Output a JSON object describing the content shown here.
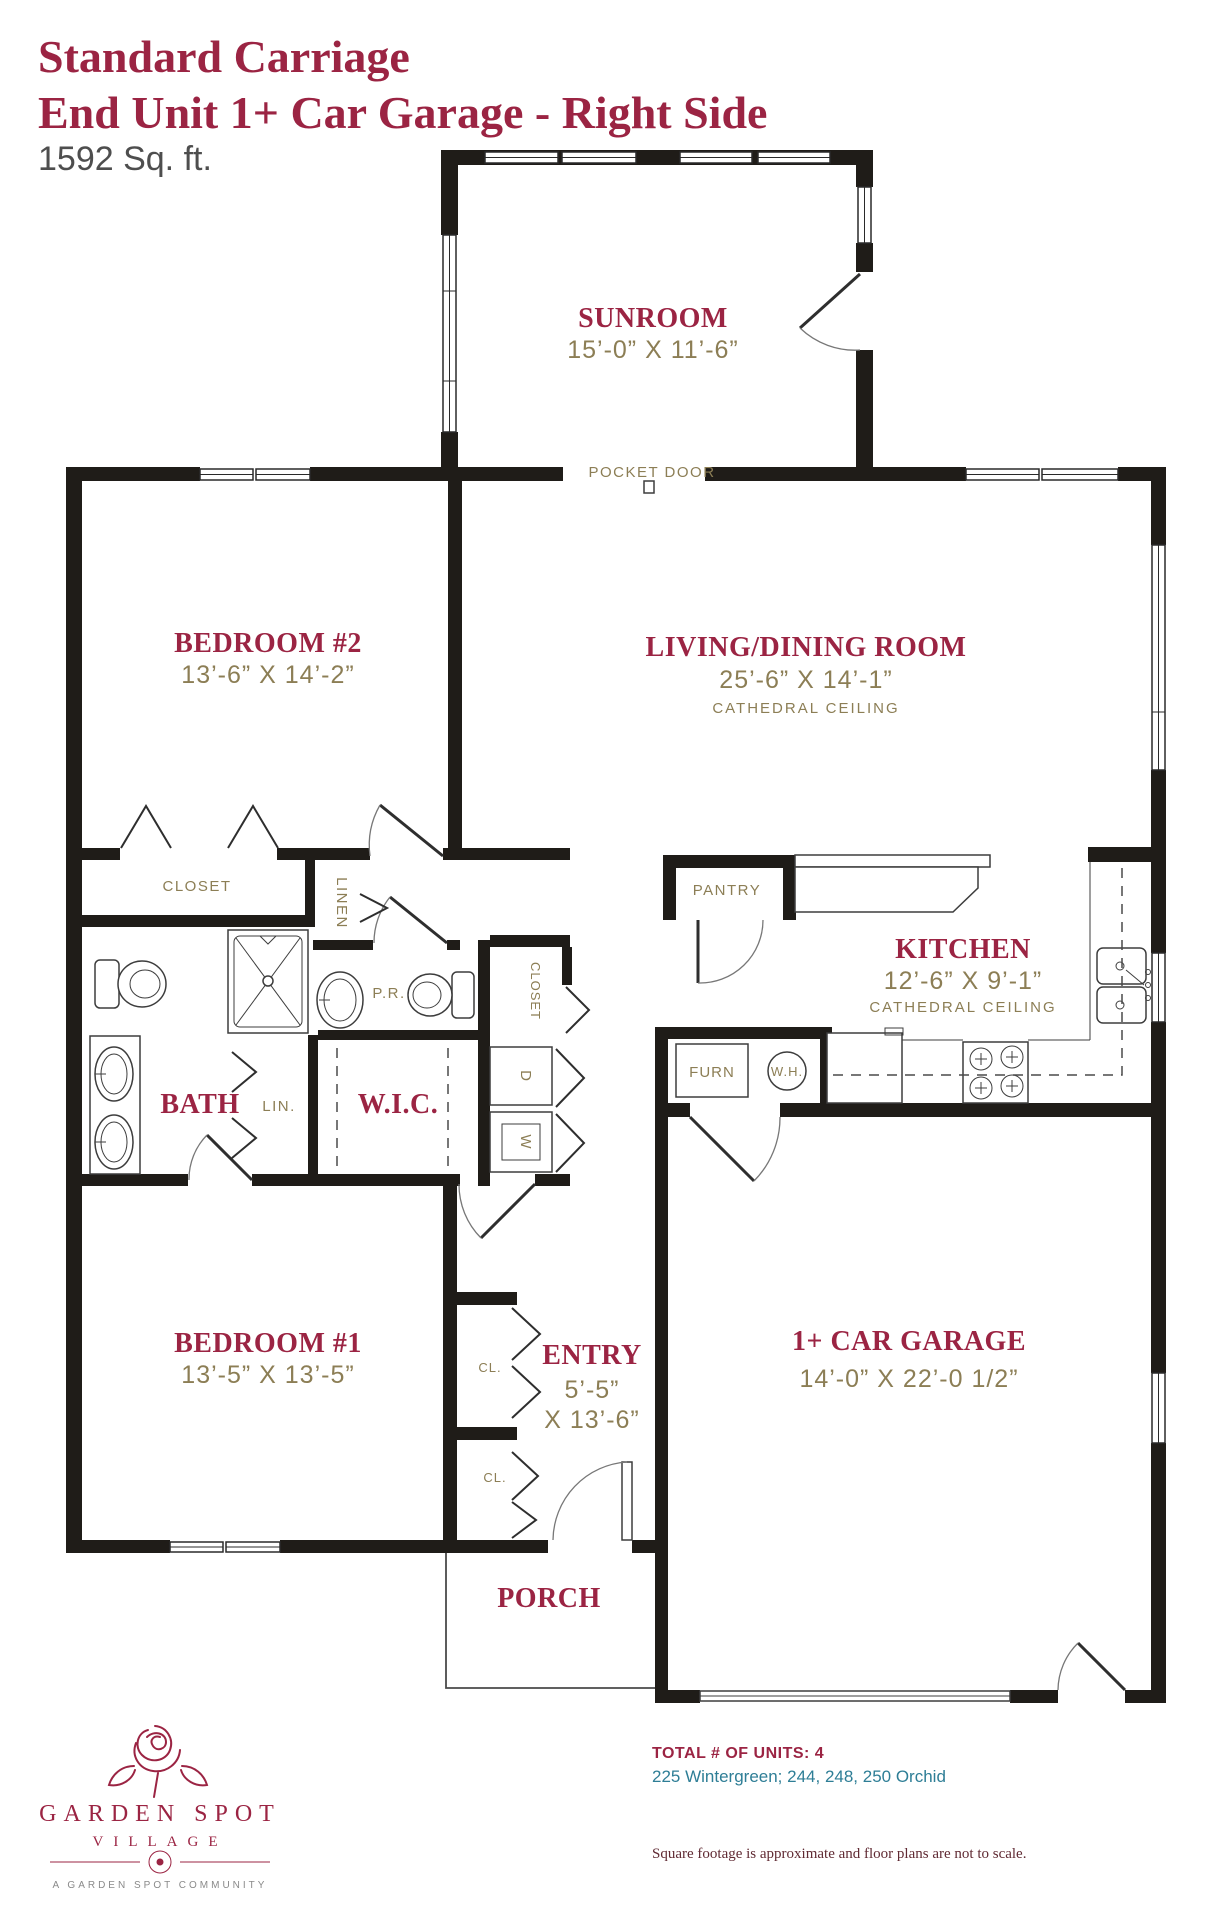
{
  "title": {
    "line1": "Standard Carriage",
    "line2": "End Unit 1+ Car Garage - Right Side",
    "sqft": "1592 Sq. ft."
  },
  "rooms": {
    "sunroom": {
      "name": "SUNROOM",
      "dims": "15’-0” X 11’-6”"
    },
    "bedroom2": {
      "name": "BEDROOM #2",
      "dims": "13’-6” X 14’-2”"
    },
    "living": {
      "name": "LIVING/DINING ROOM",
      "dims": "25’-6” X 14’-1”",
      "note": "CATHEDRAL CEILING"
    },
    "kitchen": {
      "name": "KITCHEN",
      "dims": "12’-6” X 9’-1”",
      "note": "CATHEDRAL CEILING"
    },
    "bath": {
      "name": "BATH"
    },
    "wic": {
      "name": "W.I.C."
    },
    "bedroom1": {
      "name": "BEDROOM #1",
      "dims": "13’-5” X 13’-5”"
    },
    "entry": {
      "name": "ENTRY",
      "dims_line1": "5’-5”",
      "dims_line2": "X 13’-6”"
    },
    "garage": {
      "name": "1+ CAR GARAGE",
      "dims": "14’-0” X 22’-0 1/2”"
    },
    "porch": {
      "name": "PORCH"
    }
  },
  "small_labels": {
    "pocket_door": "POCKET DOOR",
    "hall_closet": "CLOSET",
    "linen": "LINEN",
    "powder_room": "P.R.",
    "closet_vertical": "CLOSET",
    "pantry": "PANTRY",
    "lin": "LIN.",
    "dryer": "D",
    "washer": "W",
    "furnace": "FURN",
    "water_heater": "W.H.",
    "closet1": "CL.",
    "closet2": "CL."
  },
  "footer": {
    "brand_line1": "GARDEN SPOT",
    "brand_line2": "VILLAGE",
    "brand_tagline": "A GARDEN SPOT COMMUNITY",
    "units_label": "TOTAL # OF UNITS: 4",
    "units_addresses": "225 Wintergreen; 244, 248, 250 Orchid",
    "disclaimer": "Square footage is approximate and floor plans are not to scale."
  },
  "colors": {
    "room_label": "#9B2443",
    "dimension_text": "#8C7E55",
    "wall": "#1F1C18",
    "addresses": "#2E7E96",
    "disclaimer": "#602A33",
    "sqft_text": "#4E4E4E"
  }
}
